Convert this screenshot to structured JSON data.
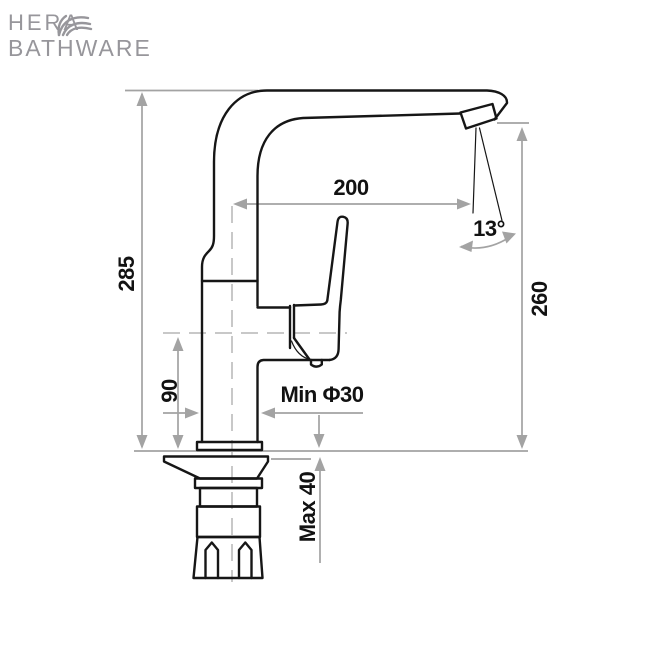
{
  "logo": {
    "line1": "HERA",
    "line2": "BATHWARE",
    "color": "#97969b",
    "icon": "palm-frond"
  },
  "diagram": {
    "type": "faucet-technical-drawing",
    "line_color": "#161616",
    "dimension_color": "#a3a3a3",
    "label_color": "#121212",
    "dimensions": {
      "overall_height": "285",
      "spout_reach": "200",
      "body_height": "90",
      "outlet_height": "260",
      "spout_angle": "13°",
      "min_hole_diameter": "Min Φ30",
      "max_deck_thickness": "Max 40"
    }
  }
}
